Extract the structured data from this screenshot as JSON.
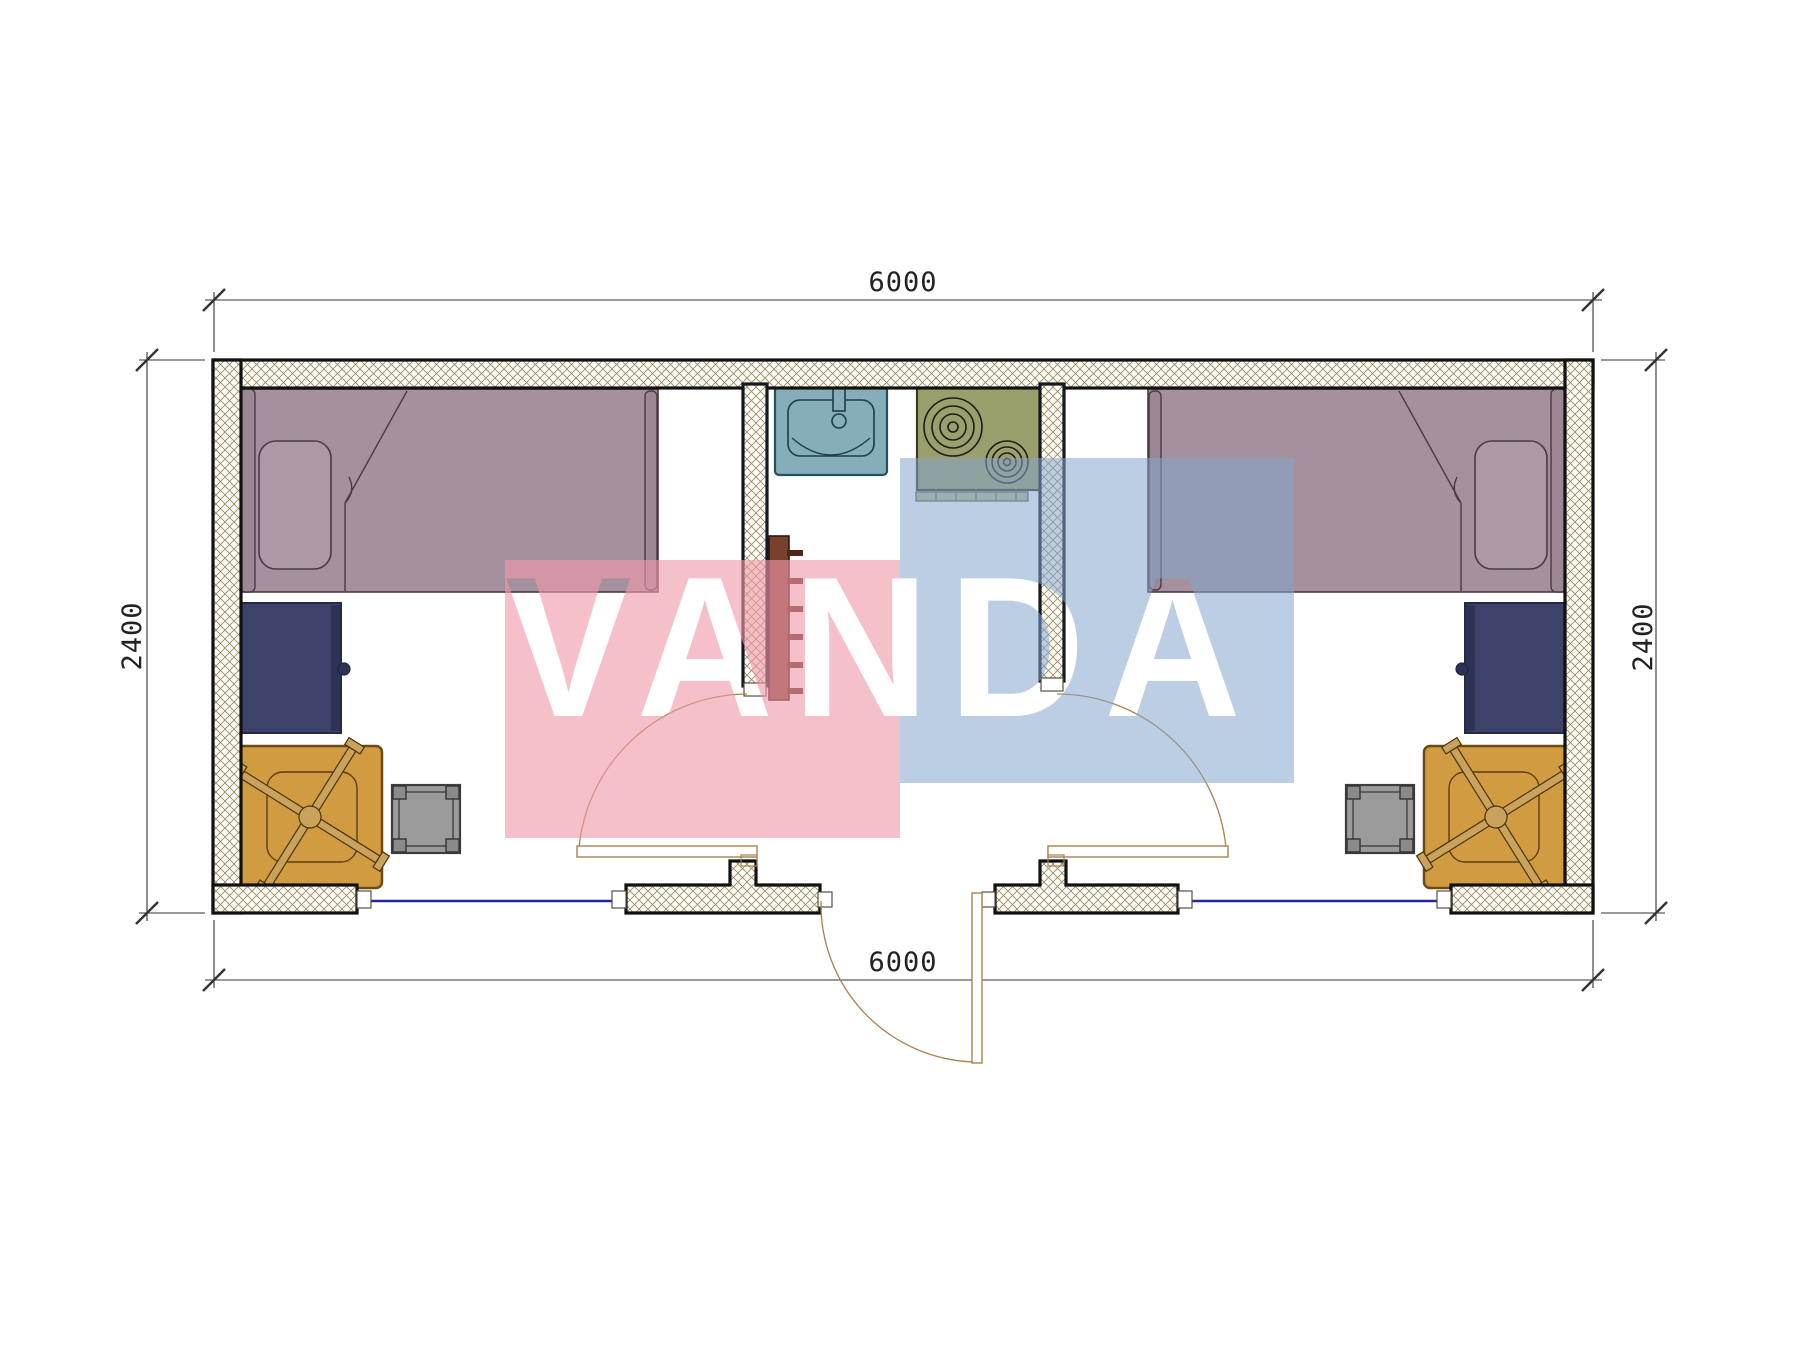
{
  "watermark": {
    "text": "VANDA",
    "pink_block_color": "rgba(240,153,169,0.62)",
    "blue_block_color": "rgba(133,166,204,0.55)"
  },
  "dimensions": {
    "top_width": "6000",
    "bottom_width": "6000",
    "left_height": "2400",
    "right_height": "2400"
  },
  "colors": {
    "bed": "#a5919e",
    "bed_board": "#9c8894",
    "pillow": "#ac99a5",
    "desk_navy": "#3c4269",
    "desk_navy_strip": "#2d3357",
    "desk_orange": "#d09b41",
    "chair": "#c9a25c",
    "stool": "#9b9b9b",
    "stool_post": "#8a8a8a",
    "sink": "#85adba",
    "stove": "#9aa06b",
    "stove_ledge": "#b9bd8d",
    "ladder": "#7a402e",
    "ladder_rung": "#4f2617",
    "window_line": "#2326a0",
    "door_line": "#a9824e",
    "wall_hatch_line": "#97875d"
  }
}
